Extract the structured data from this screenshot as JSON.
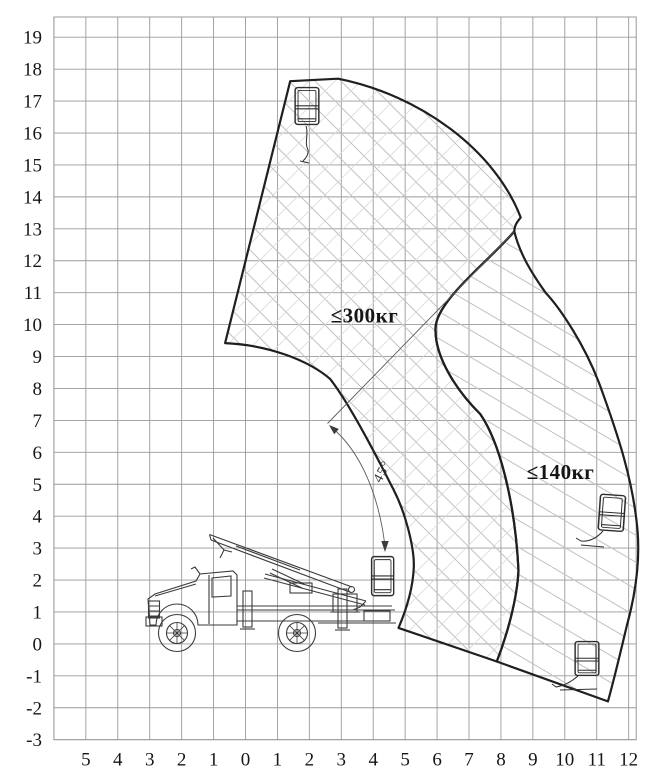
{
  "diagram": {
    "zone_labels": {
      "zone300": "≤300кг",
      "zone140": "≤140кг"
    },
    "angle_label": "45°",
    "axes": {
      "y_ticks": [
        {
          "label": "19",
          "u": 19
        },
        {
          "label": "18",
          "u": 18
        },
        {
          "label": "17",
          "u": 17
        },
        {
          "label": "16",
          "u": 16
        },
        {
          "label": "15",
          "u": 15
        },
        {
          "label": "14",
          "u": 14
        },
        {
          "label": "13",
          "u": 13
        },
        {
          "label": "12",
          "u": 12
        },
        {
          "label": "11",
          "u": 11
        },
        {
          "label": "10",
          "u": 10
        },
        {
          "label": "9",
          "u": 9
        },
        {
          "label": "8",
          "u": 8
        },
        {
          "label": "7",
          "u": 7
        },
        {
          "label": "6",
          "u": 6
        },
        {
          "label": "5",
          "u": 5
        },
        {
          "label": "4",
          "u": 4
        },
        {
          "label": "3",
          "u": 3
        },
        {
          "label": "2",
          "u": 2
        },
        {
          "label": "1",
          "u": 1
        },
        {
          "label": "0",
          "u": 0
        },
        {
          "label": "-1",
          "u": -1
        },
        {
          "label": "-2",
          "u": -2
        },
        {
          "label": "-3",
          "u": -3
        }
      ],
      "x_ticks": [
        {
          "label": "5",
          "u": -5
        },
        {
          "label": "4",
          "u": -4
        },
        {
          "label": "3",
          "u": -3
        },
        {
          "label": "2",
          "u": -2
        },
        {
          "label": "1",
          "u": -1
        },
        {
          "label": "0",
          "u": 0
        },
        {
          "label": "1",
          "u": 1
        },
        {
          "label": "2",
          "u": 2
        },
        {
          "label": "3",
          "u": 3
        },
        {
          "label": "4",
          "u": 4
        },
        {
          "label": "5",
          "u": 5
        },
        {
          "label": "6",
          "u": 6
        },
        {
          "label": "7",
          "u": 7
        },
        {
          "label": "8",
          "u": 8
        },
        {
          "label": "9",
          "u": 9
        },
        {
          "label": "10",
          "u": 10
        },
        {
          "label": "11",
          "u": 11
        },
        {
          "label": "12",
          "u": 12
        }
      ]
    },
    "colors": {
      "line": "#1f1f1f",
      "grid": "#9a9a9a",
      "hatch": "#c2c2c2",
      "background": "#ffffff"
    }
  },
  "chart_data": {
    "type": "area",
    "title": "",
    "xlabel": "",
    "ylabel": "",
    "x_range": [
      -6,
      12.2
    ],
    "y_range": [
      -3,
      19.6
    ],
    "grid": true,
    "angle_annotation_deg": 45,
    "zones": [
      {
        "label": "≤300кг",
        "max_load_kg": 300,
        "outline_xy": [
          [
            1.4,
            17.6
          ],
          [
            2.9,
            17.7
          ],
          [
            6.0,
            16.6
          ],
          [
            8.2,
            14.5
          ],
          [
            8.6,
            13.4
          ],
          [
            8.4,
            12.9
          ],
          [
            6.9,
            11.4
          ],
          [
            5.95,
            9.9
          ],
          [
            6.7,
            8.3
          ],
          [
            7.35,
            7.2
          ],
          [
            8.3,
            4.0
          ],
          [
            8.55,
            2.3
          ],
          [
            7.87,
            -0.55
          ],
          [
            4.79,
            0.5
          ],
          [
            5.27,
            2.4
          ],
          [
            4.65,
            4.8
          ],
          [
            3.8,
            6.4
          ],
          [
            2.65,
            8.3
          ],
          [
            1.4,
            9.05
          ],
          [
            -0.64,
            9.4
          ]
        ]
      },
      {
        "label": "≤140кг",
        "max_load_kg": 140,
        "outline_xy": [
          [
            8.4,
            12.9
          ],
          [
            9.4,
            11.0
          ],
          [
            10.2,
            10.1
          ],
          [
            11.1,
            8.1
          ],
          [
            12.2,
            4.6
          ],
          [
            12.3,
            2.6
          ],
          [
            11.8,
            0.1
          ],
          [
            11.35,
            -1.8
          ],
          [
            7.87,
            -0.55
          ],
          [
            8.55,
            2.3
          ],
          [
            7.35,
            7.2
          ],
          [
            5.95,
            9.9
          ],
          [
            6.9,
            11.4
          ]
        ]
      }
    ],
    "basket_positions_xy": [
      [
        1.9,
        16.9
      ],
      [
        11.5,
        4.1
      ],
      [
        10.7,
        -0.5
      ],
      [
        4.3,
        2.0
      ]
    ]
  }
}
